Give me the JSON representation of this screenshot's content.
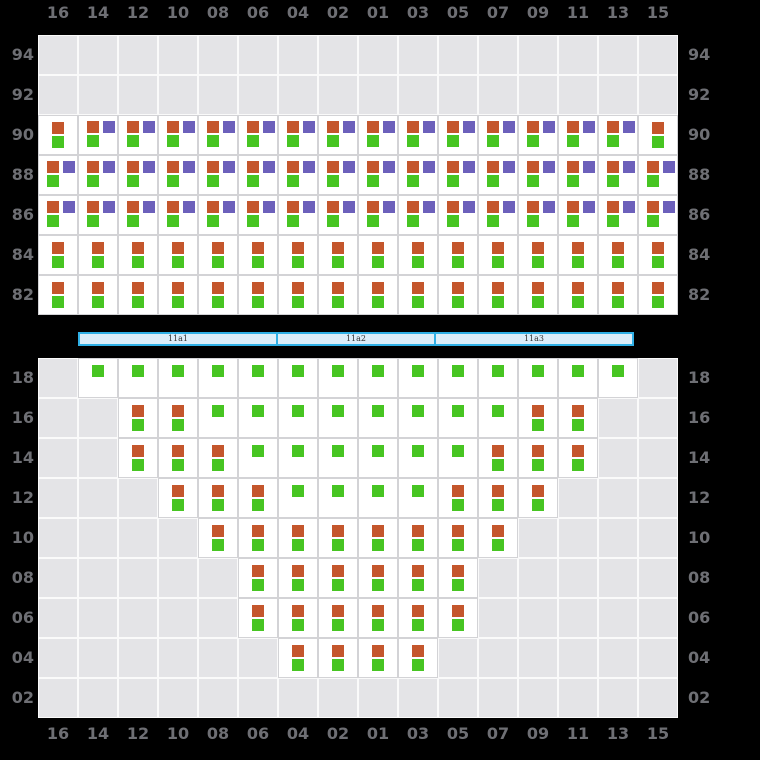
{
  "columns": [
    "16",
    "14",
    "12",
    "10",
    "08",
    "06",
    "04",
    "02",
    "01",
    "03",
    "05",
    "07",
    "09",
    "11",
    "13",
    "15"
  ],
  "deck_section": {
    "tiers": [
      "94",
      "92",
      "90",
      "88",
      "86",
      "84",
      "82"
    ],
    "rows": [
      [
        ".",
        ".",
        ".",
        ".",
        ".",
        ".",
        ".",
        ".",
        ".",
        ".",
        ".",
        ".",
        ".",
        ".",
        ".",
        "."
      ],
      [
        ".",
        ".",
        ".",
        ".",
        ".",
        ".",
        ".",
        ".",
        ".",
        ".",
        ".",
        ".",
        ".",
        ".",
        ".",
        "."
      ],
      [
        "og",
        "opg",
        "opg",
        "opg",
        "opg",
        "opg",
        "opg",
        "opg",
        "opg",
        "opg",
        "opg",
        "opg",
        "opg",
        "opg",
        "opg",
        "og"
      ],
      [
        "opg",
        "opg",
        "opg",
        "opg",
        "opg",
        "opg",
        "opg",
        "opg",
        "opg",
        "opg",
        "opg",
        "opg",
        "opg",
        "opg",
        "opg",
        "opg"
      ],
      [
        "opg",
        "opg",
        "opg",
        "opg",
        "opg",
        "opg",
        "opg",
        "opg",
        "opg",
        "opg",
        "opg",
        "opg",
        "opg",
        "opg",
        "opg",
        "opg"
      ],
      [
        "og",
        "og",
        "og",
        "og",
        "og",
        "og",
        "og",
        "og",
        "og",
        "og",
        "og",
        "og",
        "og",
        "og",
        "og",
        "og"
      ],
      [
        "og",
        "og",
        "og",
        "og",
        "og",
        "og",
        "og",
        "og",
        "og",
        "og",
        "og",
        "og",
        "og",
        "og",
        "og",
        "og"
      ]
    ]
  },
  "hold_section": {
    "tiers": [
      "18",
      "16",
      "14",
      "12",
      "10",
      "08",
      "06",
      "04",
      "02"
    ],
    "rows": [
      [
        ".",
        "g",
        "g",
        "g",
        "g",
        "g",
        "g",
        "g",
        "g",
        "g",
        "g",
        "g",
        "g",
        "g",
        "g",
        "."
      ],
      [
        ".",
        ".",
        "og",
        "og",
        "g",
        "g",
        "g",
        "g",
        "g",
        "g",
        "g",
        "g",
        "og",
        "og",
        ".",
        "."
      ],
      [
        ".",
        ".",
        "og",
        "og",
        "og",
        "g",
        "g",
        "g",
        "g",
        "g",
        "g",
        "og",
        "og",
        "og",
        ".",
        "."
      ],
      [
        ".",
        ".",
        ".",
        "og",
        "og",
        "og",
        "g",
        "g",
        "g",
        "g",
        "og",
        "og",
        "og",
        ".",
        ".",
        "."
      ],
      [
        ".",
        ".",
        ".",
        ".",
        "og",
        "og",
        "og",
        "og",
        "og",
        "og",
        "og",
        "og",
        ".",
        ".",
        ".",
        "."
      ],
      [
        ".",
        ".",
        ".",
        ".",
        ".",
        "og",
        "og",
        "og",
        "og",
        "og",
        "og",
        ".",
        ".",
        ".",
        ".",
        "."
      ],
      [
        ".",
        ".",
        ".",
        ".",
        ".",
        "og",
        "og",
        "og",
        "og",
        "og",
        "og",
        ".",
        ".",
        ".",
        ".",
        "."
      ],
      [
        ".",
        ".",
        ".",
        ".",
        ".",
        ".",
        "og",
        "og",
        "og",
        "og",
        ".",
        ".",
        ".",
        ".",
        ".",
        "."
      ],
      [
        ".",
        ".",
        ".",
        ".",
        ".",
        ".",
        ".",
        ".",
        ".",
        ".",
        ".",
        ".",
        ".",
        ".",
        ".",
        "."
      ]
    ]
  },
  "hatch_covers": [
    {
      "label": "11a1",
      "columns": 5
    },
    {
      "label": "11a2",
      "columns": 4
    },
    {
      "label": "11a3",
      "columns": 5
    }
  ],
  "colors": {
    "background": "#000000",
    "orange": "#c4562c",
    "green": "#47c522",
    "purple": "#6c60bb",
    "empty_cell": "#e4e4e7",
    "empty_cell_border": "#fafafa",
    "slot_cell": "#ffffff",
    "slot_cell_border": "#d3d3d6",
    "label_text": "#6e6f74",
    "hatch_fill": "#dceefa",
    "hatch_border": "#30b0e6",
    "hatch_label_text": "#333333"
  }
}
